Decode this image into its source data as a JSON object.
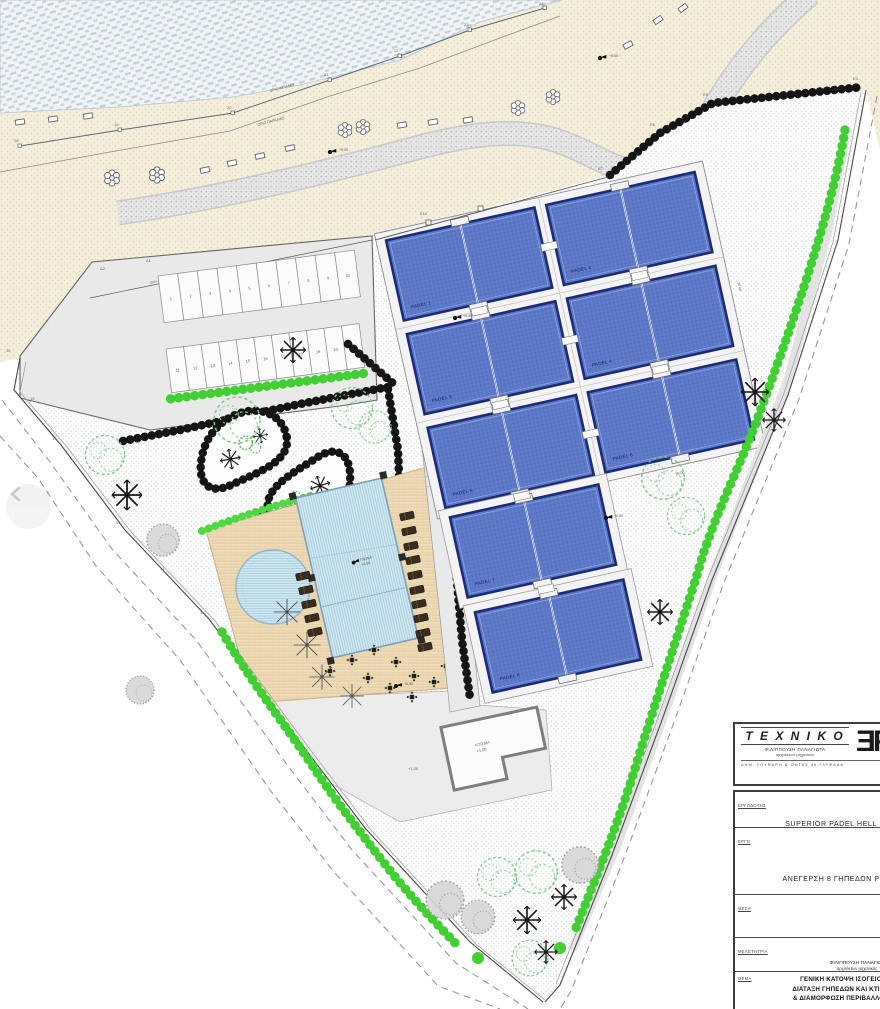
{
  "carousel": {
    "prev_icon_name": "chevron-left"
  },
  "title_block": {
    "brand": {
      "name": "T E X N I K O",
      "person": "ΦΙΛΙΠΠΟΥΣΗ ΠΑΝΑΓΙΩΤΑ",
      "role": "αρχιτέκτων μηχανικός",
      "address": "ΔΗΜ. ΓΟΥΝΑΡΗ & ΟΝΤΑΣ 40 ΓΛΥΦΑΔΑ",
      "logo_glyph": "ƎF",
      "right_note": "ΦΩΤΟΓΡ"
    },
    "rows": {
      "client_label": "ΕΡΓΟΔΟΤΗΣ",
      "client": "SUPERIOR PADEL HELL",
      "project_label": "ΕΡΓΟ",
      "project": "ΑΝΕΓΕΡΣΗ 8 ΓΗΠΕΔΩΝ Ρ",
      "location_label": "ΘΕΣΗ",
      "location": "",
      "designer_label": "ΜΕΛΕΤΗΤΡΙΑ",
      "designer": "ΦΙΛΙΠΠΟΥΣΗ ΠΑΝΑΓΙΩΤ",
      "designer_role": "αρχιτέκτων μηχανικός",
      "subject_label": "ΘΕΜΑ",
      "subject_line1": "ΓΕΝΙΚΗ ΚΑΤΟΨΗ ΙΣΟΓΕΙΟΥ",
      "subject_line2": "ΔΙΑΤΑΞΗ ΓΗΠΕΔΩΝ ΚΑΙ ΚΤΙΣΜΑ",
      "subject_line3": "& ΔΙΑΜΟΡΦΩΣΗ ΠΕΡΙΒΑΛΛΟΝΤ"
    }
  },
  "plan": {
    "courts": [
      {
        "label": "PADEL 1"
      },
      {
        "label": "PADEL 2"
      },
      {
        "label": "PADEL 3"
      },
      {
        "label": "PADEL 4"
      },
      {
        "label": "PADEL 5"
      },
      {
        "label": "PADEL 6"
      },
      {
        "label": "PADEL 7"
      },
      {
        "label": "PADEL 8"
      }
    ],
    "parking_row1": [
      "1",
      "2",
      "3",
      "4",
      "5",
      "6",
      "7",
      "8",
      "9",
      "10"
    ],
    "parking_row2": [
      "11",
      "12",
      "13",
      "14",
      "15",
      "16",
      "17",
      "18",
      "19",
      "20",
      "21"
    ],
    "shore_points": [
      "18",
      "19",
      "20",
      "21",
      "22",
      "23",
      "24"
    ],
    "left_points": [
      "16",
      "15",
      "14",
      "13",
      "12",
      "11"
    ],
    "hedge_points": [
      "Ε7",
      "Ε6",
      "Ε5",
      "Ε4"
    ],
    "delta_points": [
      "Δ2",
      "Δ1"
    ],
    "labels": {
      "shore_line1": "ΟΡΙΟ ΑΙΓΙΑΛΟΥ",
      "shore_line2": "ΟΡΙΟ ΠΑΡΑΛΙΑΣ",
      "concession": "ΟΡΙΑ ΠΑΡΑΧΩΡΗΣΗΣ ΧΡΗΣΗΣ",
      "fence_point": "Ε10",
      "pool": "ΠΙΣΙΝΑ",
      "pool_elev": "+0.50",
      "building": "ΚΤΙΣΜΑ",
      "building_elev": "+1.00",
      "terrace_elev": "+1.00",
      "junction_elev": "+0.50",
      "east_elev": "+0.50",
      "deck_elev": "+0.50",
      "beach_elev": "+0.00",
      "court_width": "10.00",
      "court_length": "20.00"
    }
  },
  "colors": {
    "court_blue": "#5d78c6",
    "court_border": "#1c2b74",
    "pool_blue": "#cfe7f0",
    "deck_tan": "#eedcb9",
    "sand": "#f4eedd",
    "hedge_green": "#41cf33",
    "hedge_black": "#151515",
    "sea_hatch": "#c3ced6"
  }
}
